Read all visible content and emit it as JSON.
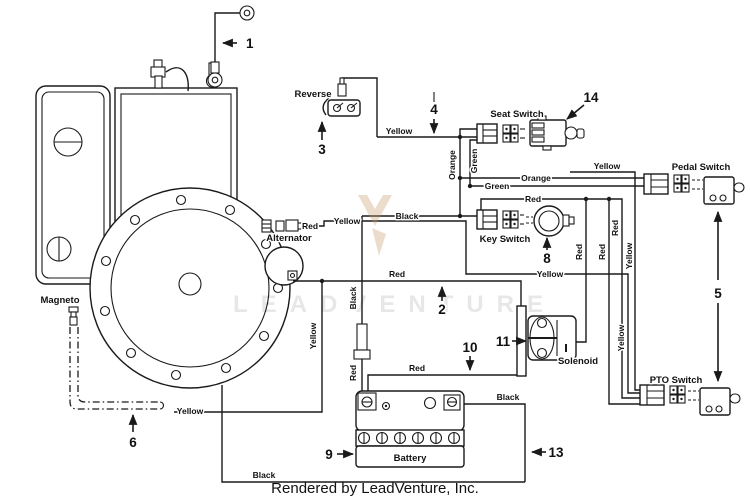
{
  "watermark": {
    "text": "LEADVENTURE"
  },
  "footer": {
    "credit": "Rendered by LeadVenture, Inc."
  },
  "components": {
    "reverse": "Reverse",
    "seat_switch": "Seat Switch",
    "pedal_switch": "Pedal Switch",
    "key_switch": "Key Switch",
    "pto_switch": "PTO Switch",
    "alternator": "Alternator",
    "magneto": "Magneto",
    "solenoid": "Solenoid",
    "battery": "Battery"
  },
  "callouts": {
    "c1": "1",
    "c2": "2",
    "c3": "3",
    "c4": "4",
    "c5": "5",
    "c6": "6",
    "c8": "8",
    "c9": "9",
    "c10": "10",
    "c11": "11",
    "c13": "13",
    "c14": "14"
  },
  "wire_colors": {
    "yellow": "Yellow",
    "orange": "Orange",
    "green": "Green",
    "red": "Red",
    "black": "Black"
  },
  "colors": {
    "line": "#1a1a1a",
    "background": "#ffffff"
  }
}
